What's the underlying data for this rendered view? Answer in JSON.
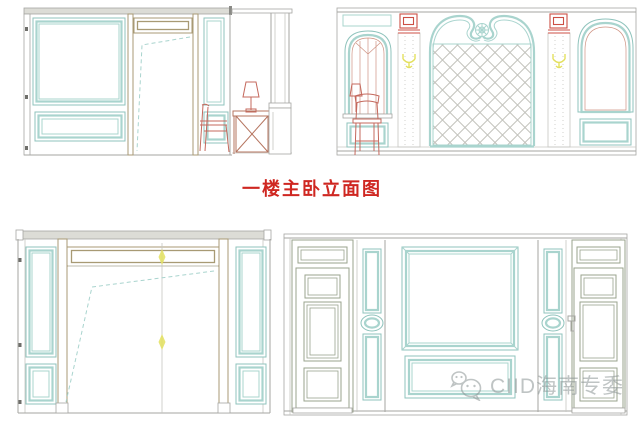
{
  "title": {
    "text": "一楼主卧立面图"
  },
  "watermark": {
    "text": "CIID海南专委",
    "logo": "wechat-logo"
  },
  "colors": {
    "teal": "#a9d4ce",
    "teal-dark": "#8fc3bc",
    "tan": "#a89a74",
    "tan2": "#b5745f",
    "olive": "#9aa38e",
    "gray": "#a6a6a2",
    "gray-light": "#c6c6c2",
    "gray-dark": "#6e6e6a",
    "cornice": "#dcdcd6",
    "floral": "#5c615c",
    "lattice": "#c3c3bd",
    "grid-pink": "#e3b8b0",
    "grid-tan": "#cfc6ac",
    "hatch": "#dcc3b4",
    "red": "#c4685c",
    "red-bright": "#cc4f44",
    "win-red": "#cf9383",
    "yellow": "#e3e05e",
    "title-red": "#cf2721",
    "watermark-gray": "#8b9494"
  }
}
